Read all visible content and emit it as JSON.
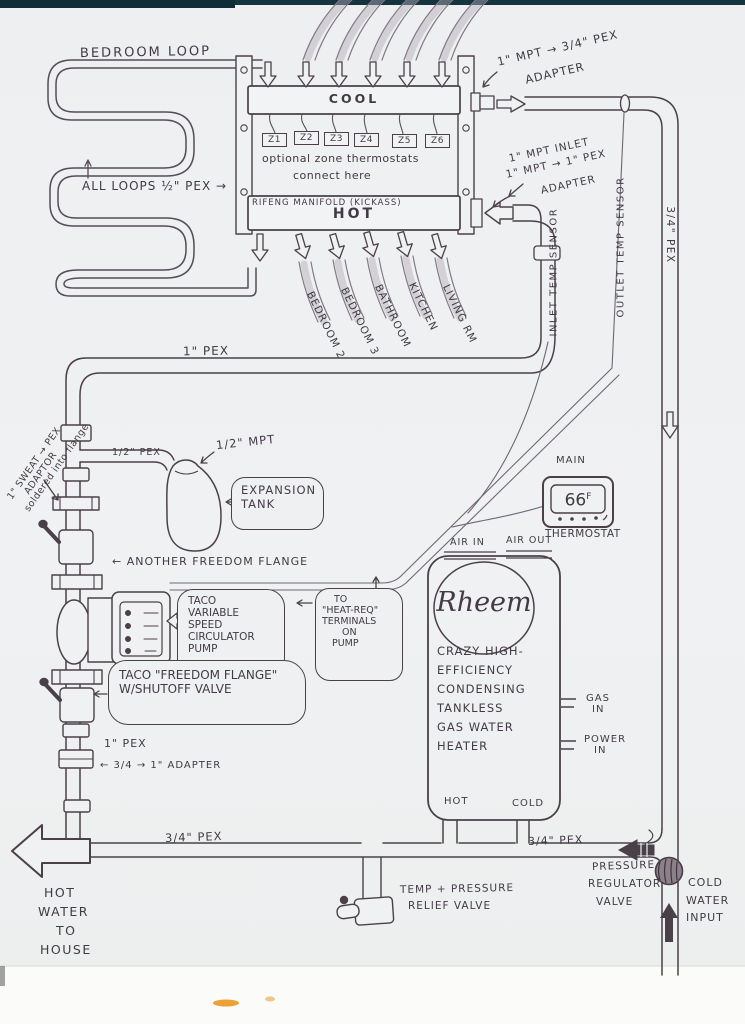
{
  "colors": {
    "ink": "#4a4148",
    "paper": "#eef0f2",
    "pencil": "#a79fab",
    "scan_bar": "#123039",
    "smudge": "#e79012"
  },
  "loop": {
    "title": "BEDROOM LOOP",
    "note": "ALL LOOPS ½\" PEX →"
  },
  "manifold": {
    "cool": "COOL",
    "hot": "HOT",
    "name": "RIFENG MANIFOLD (KICKASS)",
    "zones": [
      "Z1",
      "Z2",
      "Z3",
      "Z4",
      "Z5",
      "Z6"
    ],
    "zone_note": [
      "optional zone thermostats",
      "connect here"
    ]
  },
  "adapters": {
    "cool_out": [
      "1\" MPT → 3/4\" PEX",
      "ADAPTER"
    ],
    "hot_in": [
      "1\" MPT INLET",
      "1\" MPT → 1\" PEX",
      "ADAPTER"
    ],
    "sweat": [
      "1\" SWEAT → PEX",
      "ADAPTOR",
      "soldered into flange"
    ],
    "riser": "← 3/4 → 1\" ADAPTER"
  },
  "rooms": [
    "BEDROOM 2",
    "BEDROOM 3",
    "BATHROOM",
    "KITCHEN",
    "LIVING RM"
  ],
  "sensors": {
    "inlet": "INLET TEMP SENSOR",
    "outlet": "OUTLET TEMP SENSOR"
  },
  "pipes": {
    "main_supply": "1\" PEX",
    "right_drop": "3/4\" PEX",
    "half_branch": "1/2\" PEX",
    "half_mpt": "1/2\" MPT",
    "riser": "1\" PEX",
    "bottom_left": "3/4\" PEX",
    "bottom_right": "3/4\" PEX"
  },
  "expansion_tank": [
    "EXPANSION",
    "TANK"
  ],
  "thermostat": {
    "location": "MAIN",
    "temp": "66",
    "unit": "F",
    "label": "THERMOSTAT"
  },
  "flange_note": "← ANOTHER FREEDOM FLANGE",
  "pump_callout": [
    "TACO",
    "VARIABLE",
    "SPEED",
    "CIRCULATOR",
    "PUMP"
  ],
  "heat_req_callout": [
    "TO",
    "\"HEAT-REQ\"",
    "TERMINALS",
    "ON",
    "PUMP"
  ],
  "shutoff_callout": [
    "TACO \"FREEDOM FLANGE\"",
    "W/SHUTOFF VALVE"
  ],
  "heater": {
    "brand": "Rheem",
    "air_in": "AIR IN",
    "air_out": "AIR OUT",
    "desc": [
      "CRAZY HIGH-",
      "EFFICIENCY",
      "CONDENSING",
      "TANKLESS",
      "GAS WATER",
      "HEATER"
    ],
    "gas": [
      "GAS",
      "IN"
    ],
    "power": [
      "POWER",
      "IN"
    ],
    "hot": "HOT",
    "cold": "COLD"
  },
  "bottom": {
    "house": [
      "HOT",
      "WATER",
      "TO",
      "HOUSE"
    ],
    "tp_valve": [
      "TEMP + PRESSURE",
      "RELIEF VALVE"
    ],
    "prv": [
      "PRESSURE",
      "REGULATOR",
      "VALVE"
    ],
    "cold_in": [
      "COLD",
      "WATER",
      "INPUT"
    ]
  }
}
